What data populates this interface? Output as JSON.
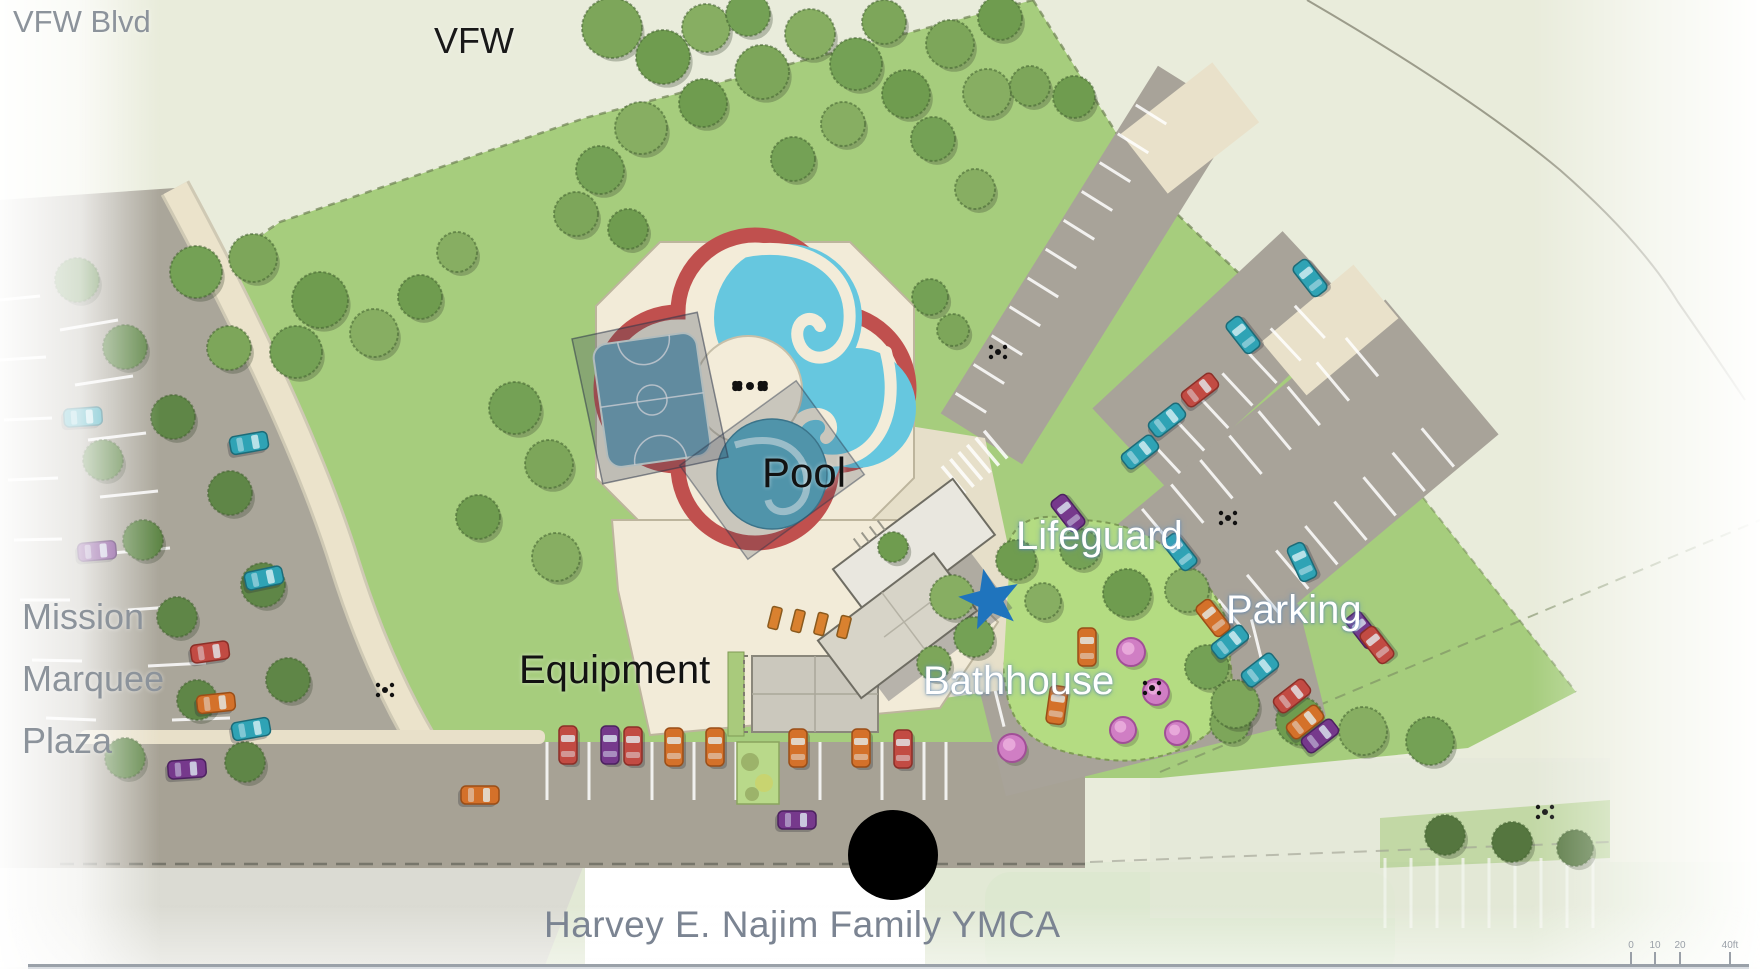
{
  "page": {
    "kind": "site-plan-rendering",
    "facility": "Harvey E. Najim Family YMCA"
  },
  "labels": {
    "street": {
      "text": "VFW Blvd",
      "color": "#8c939b"
    },
    "area_top": {
      "text": "VFW",
      "color": "#191919"
    },
    "pool": {
      "text": "Pool",
      "color": "#121212"
    },
    "lifeguard": {
      "text": "Lifeguard",
      "color": "#ffffff"
    },
    "parking": {
      "text": "Parking",
      "color": "#ffffff"
    },
    "equipment": {
      "text": "Equipment",
      "color": "#121212"
    },
    "bathhouse": {
      "text": "Bathhouse",
      "color": "#ffffff"
    },
    "plaza": {
      "text": "Mission\nMarquee\nPlaza",
      "color": "#8c939b"
    },
    "caption": {
      "text": "Harvey E. Najim Family YMCA",
      "color": "#7b8492"
    }
  },
  "markers": {
    "star": {
      "name": "lifeguard-station-star",
      "shape": "star",
      "color": "#1f74bd",
      "x": 990,
      "y": 600,
      "outer_r": 32,
      "rotation": -12
    },
    "dot": {
      "name": "entrance-point-dot",
      "shape": "circle",
      "color": "#000000",
      "x": 893,
      "y": 855,
      "r": 45
    }
  },
  "scale_bar": {
    "ticks": [
      "0",
      "10",
      "20",
      "40ft"
    ]
  },
  "palette": {
    "lawn_green": "#a6cd7d",
    "pale_field": "#e9ecdb",
    "asphalt_gray": "#a8a398",
    "deck_cream": "#f2ebd8",
    "pool_border_red": "#c0504e",
    "water_cyan": "#66c7df",
    "star_blue": "#1f74bd"
  }
}
